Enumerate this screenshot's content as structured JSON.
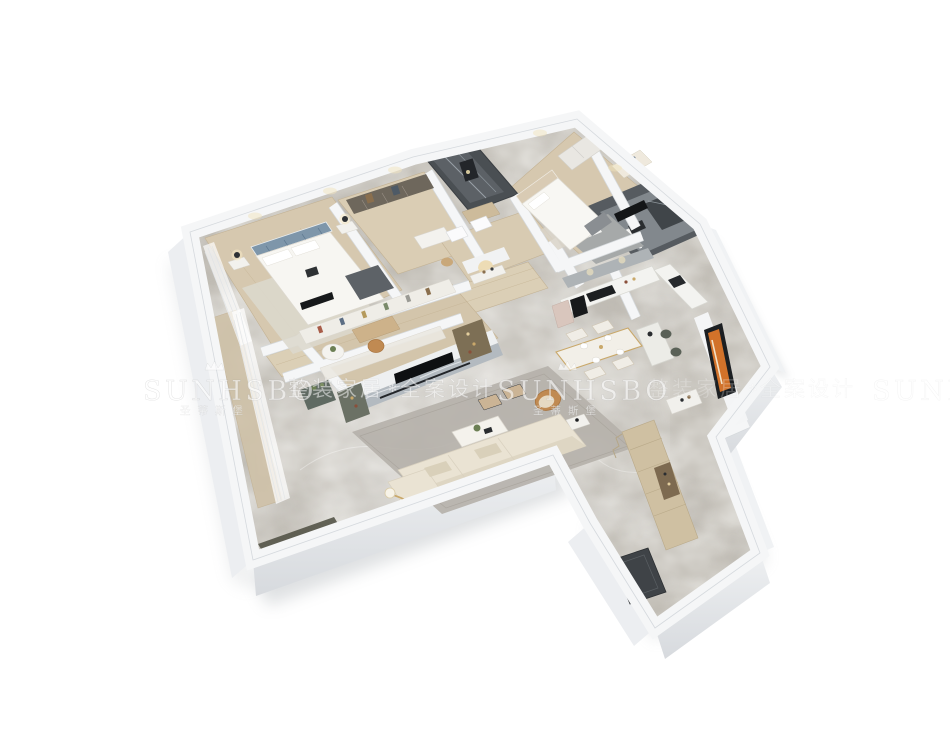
{
  "scene": {
    "background": "#ffffff",
    "description": "3D isometric rendering of a furnished apartment floor plan viewed from above"
  },
  "watermark": {
    "brand": "SUNHSBO",
    "brand_cn": "圣蒂斯堡",
    "slogan_1": "整装家居",
    "slogan_2": "全案设计",
    "separator": "✻",
    "text_color": "#ffffff",
    "text_opacity": 0.55
  },
  "palette": {
    "wall_top": "#f5f6f7",
    "wall_face_light": "#f0f2f4",
    "wall_face_dark": "#d8dbdf",
    "floor_marble": "#c1bdb5",
    "floor_wood": "#d6c8af",
    "dark_tile": "#515559",
    "rug_living": "#b5b0aa",
    "rug_bedroom": "#dcd8cd",
    "sofa": "#eae3d3",
    "accent_chair": "#c08a52",
    "headboard_blue": "#7e96aa",
    "cabinet_tan": "#cfc0a2",
    "artwork_orange": "#d2722a",
    "doormat": "#3f4347"
  }
}
